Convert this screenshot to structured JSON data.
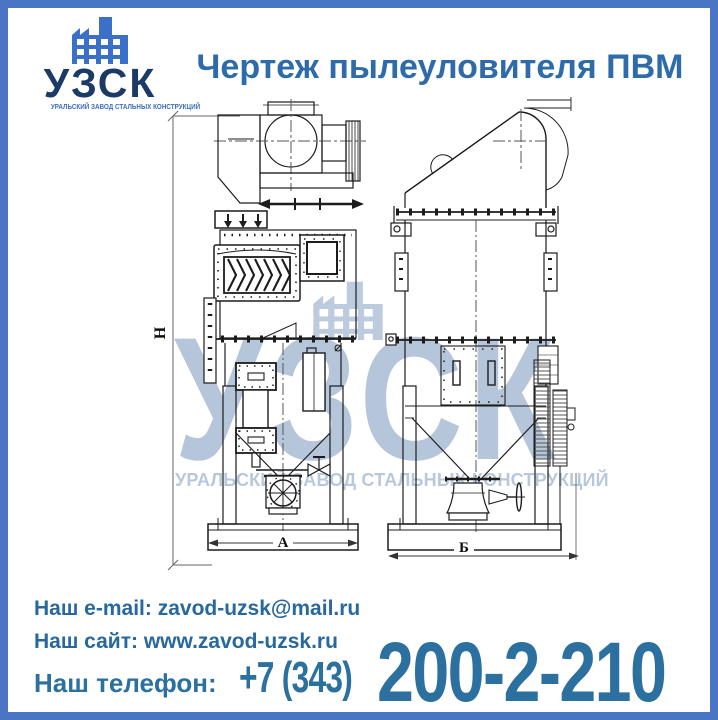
{
  "theme": {
    "frame_color": "#4a74c4",
    "background": "#ffffff",
    "title_color": "#2d6ca9",
    "contact_color": "#27689d",
    "phone_color": "#2b709f",
    "logo_text_color": "#1b3a67",
    "logo_accent_color": "#3a70c8",
    "watermark_color": "#aebfd6",
    "drawing_line_color": "#1c1c1c"
  },
  "logo": {
    "icon": "factory-icon",
    "name": "УЗСК",
    "tagline": "УРАЛЬСКИЙ ЗАВОД СТАЛЬНЫХ КОНСТРУКЦИЙ"
  },
  "header": {
    "title": "Чертеж пылеуловителя ПВМ"
  },
  "drawing": {
    "dimension_labels": {
      "height": "Н",
      "front_width": "А",
      "side_width": "Б"
    },
    "watermark": {
      "text": "УЗСК",
      "tagline": "УРАЛЬСКИЙ ЗАВОД СТАЛЬНЫХ КОНСТРУКЦИЙ"
    }
  },
  "contacts": {
    "email_label": "Наш e-mail:",
    "email_value": "zavod-uzsk@mail.ru",
    "site_label": "Наш сайт:",
    "site_value": "www.zavod-uzsk.ru",
    "phone_label": "Наш телефон:",
    "phone_code": "+7 (343)",
    "phone_number": "200-2-210"
  }
}
